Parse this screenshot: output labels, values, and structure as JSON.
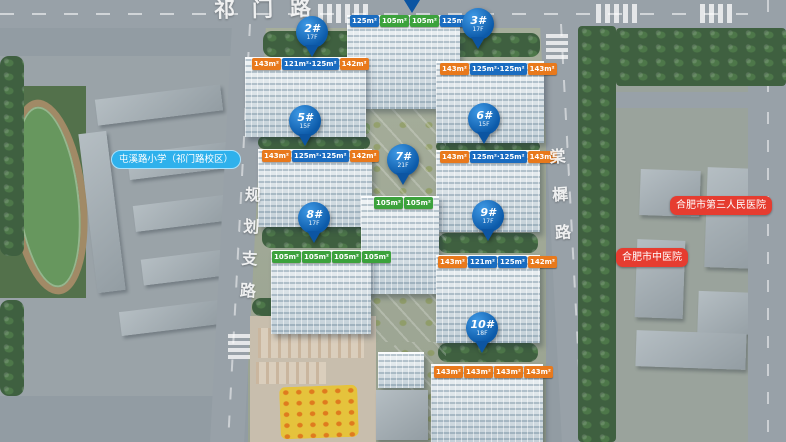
{
  "roads": {
    "top": "祁门路",
    "left": "规划支路",
    "right": "棠樨路"
  },
  "pois": {
    "school": "屯溪路小学（祁门路校区）",
    "hospital_third": "合肥市第三人民医院",
    "hospital_tcm": "合肥市中医院"
  },
  "markers": [
    {
      "num": "2#",
      "sub": "17F"
    },
    {
      "num": "3#",
      "sub": "17F"
    },
    {
      "num": "5#",
      "sub": "15F"
    },
    {
      "num": "6#",
      "sub": "15F"
    },
    {
      "num": "7#",
      "sub": "21F"
    },
    {
      "num": "8#",
      "sub": "17F"
    },
    {
      "num": "9#",
      "sub": "17F"
    },
    {
      "num": "10#",
      "sub": "18F"
    }
  ],
  "buildings": {
    "b1": {
      "units": [
        {
          "t": "125m²",
          "c": "blue"
        },
        {
          "t": "105m²",
          "c": "green"
        },
        {
          "t": "105m²",
          "c": "green"
        },
        {
          "t": "125m²",
          "c": "blue"
        }
      ]
    },
    "b2": {
      "units": [
        {
          "t": "143m²",
          "c": "orange"
        },
        {
          "t": "121m²·125m²",
          "c": "blue"
        },
        {
          "t": "142m²",
          "c": "orange"
        }
      ]
    },
    "b3": {
      "units": [
        {
          "t": "143m²",
          "c": "orange"
        },
        {
          "t": "125m²·125m²",
          "c": "blue"
        },
        {
          "t": "143m²",
          "c": "orange"
        }
      ]
    },
    "b5": {
      "units": [
        {
          "t": "143m²",
          "c": "orange"
        },
        {
          "t": "125m²·125m²",
          "c": "blue"
        },
        {
          "t": "142m²",
          "c": "orange"
        }
      ]
    },
    "b6": {
      "units": [
        {
          "t": "143m²",
          "c": "orange"
        },
        {
          "t": "125m²·125m²",
          "c": "blue"
        },
        {
          "t": "143m²",
          "c": "orange"
        }
      ]
    },
    "b7": {
      "units": [
        {
          "t": "105m²",
          "c": "green"
        },
        {
          "t": "105m²",
          "c": "green"
        }
      ]
    },
    "b8": {
      "units": [
        {
          "t": "105m²",
          "c": "green"
        },
        {
          "t": "105m²",
          "c": "green"
        },
        {
          "t": "105m²",
          "c": "green"
        },
        {
          "t": "105m²",
          "c": "green"
        }
      ]
    },
    "b9": {
      "units": [
        {
          "t": "143m²",
          "c": "orange"
        },
        {
          "t": "121m²",
          "c": "blue"
        },
        {
          "t": "125m²",
          "c": "blue"
        },
        {
          "t": "142m²",
          "c": "orange"
        }
      ]
    },
    "b10": {
      "units": [
        {
          "t": "143m²",
          "c": "orange"
        },
        {
          "t": "143m²",
          "c": "orange"
        },
        {
          "t": "143m²",
          "c": "orange"
        },
        {
          "t": "143m²",
          "c": "orange"
        }
      ]
    }
  },
  "colors": {
    "pill_orange": "#e8791c",
    "pill_blue": "#1a6cc0",
    "pill_green": "#3ca23c",
    "marker_blue": "#0c5aa9",
    "school_bubble": "#2fb1ec",
    "hospital_bubble": "#e63c30",
    "garden_green": "#b9c83d"
  }
}
